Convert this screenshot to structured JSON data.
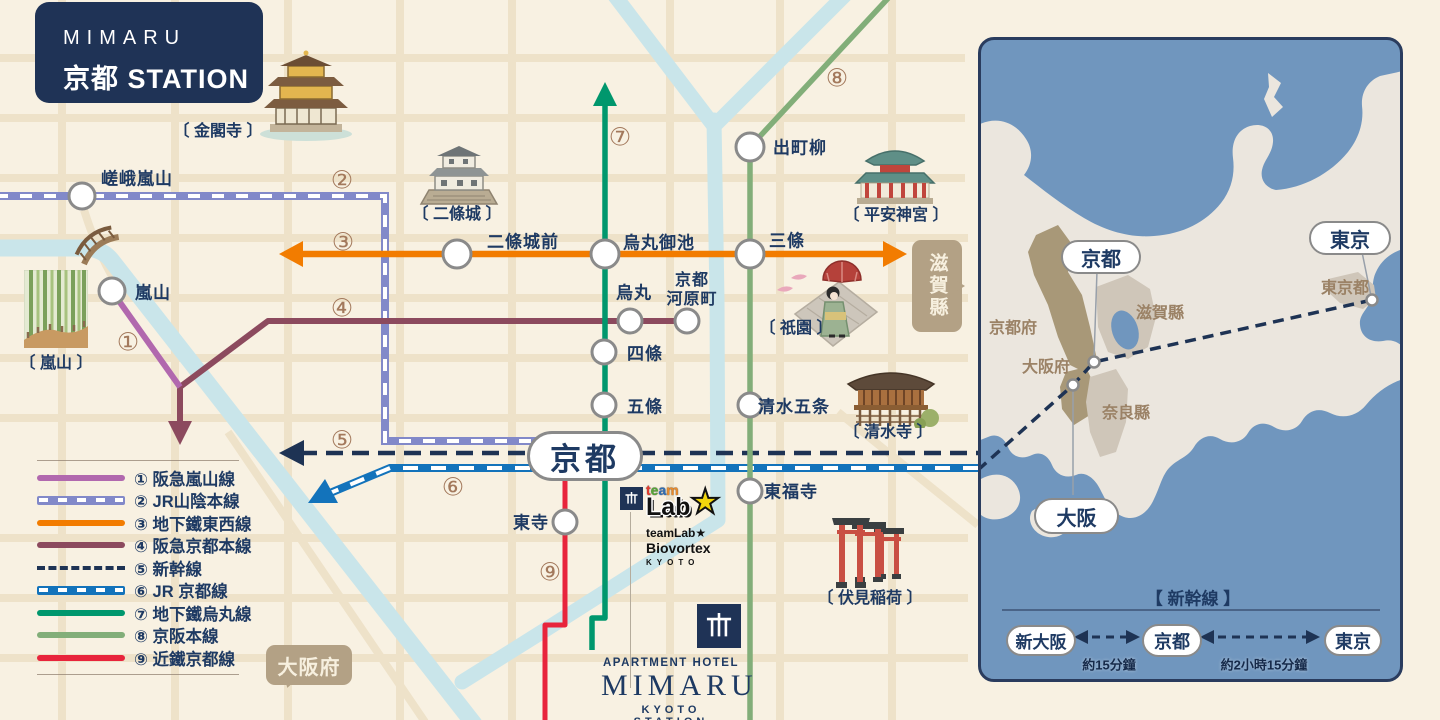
{
  "brand": {
    "line1": "MIMARU",
    "line2": "京都 STATION"
  },
  "lines": [
    {
      "badge": "①",
      "name": "阪急嵐山線",
      "legend_label": "① 阪急嵐山線",
      "color": "#b168ae",
      "style": "solid"
    },
    {
      "badge": "②",
      "name": "JR山陰本線",
      "legend_label": "② JR山陰本線",
      "color": "#8289c9",
      "style": "jr"
    },
    {
      "badge": "③",
      "name": "地下鐵東西線",
      "legend_label": "③ 地下鐵東西線",
      "color": "#f27c00",
      "style": "solid"
    },
    {
      "badge": "④",
      "name": "阪急京都本線",
      "legend_label": "④ 阪急京都本線",
      "color": "#8c4a5e",
      "style": "solid"
    },
    {
      "badge": "⑤",
      "name": "新幹線",
      "legend_label": "⑤ 新幹線",
      "color": "#1e3354",
      "style": "dashed"
    },
    {
      "badge": "⑥",
      "name": "JR京都線",
      "legend_label": "⑥ JR 京都線",
      "color": "#1373bb",
      "style": "jr"
    },
    {
      "badge": "⑦",
      "name": "地下鐵烏丸線",
      "legend_label": "⑦ 地下鐵烏丸線",
      "color": "#00976d",
      "style": "solid"
    },
    {
      "badge": "⑧",
      "name": "京阪本線",
      "legend_label": "⑧ 京阪本線",
      "color": "#82ae79",
      "style": "solid"
    },
    {
      "badge": "⑨",
      "name": "近鐵京都線",
      "legend_label": "⑨ 近鐵京都線",
      "color": "#e8243c",
      "style": "solid"
    }
  ],
  "stations": [
    {
      "name": "嵯峨嵐山"
    },
    {
      "name": "嵐山"
    },
    {
      "name": "二條城前"
    },
    {
      "name": "烏丸御池"
    },
    {
      "name": "三條"
    },
    {
      "name": "出町柳"
    },
    {
      "name": "烏丸"
    },
    {
      "name": "京都河原町",
      "line1": "京都",
      "line2": "河原町"
    },
    {
      "name": "四條"
    },
    {
      "name": "五條"
    },
    {
      "name": "清水五条"
    },
    {
      "name": "東福寺"
    },
    {
      "name": "東寺"
    }
  ],
  "hub": {
    "label": "京都"
  },
  "landmarks": [
    {
      "label": "〔 金閣寺 〕"
    },
    {
      "label": "〔 二條城 〕"
    },
    {
      "label": "〔 平安神宮 〕"
    },
    {
      "label": "〔 嵐山 〕"
    },
    {
      "label": "〔 祇園 〕"
    },
    {
      "label": "〔 清水寺 〕"
    },
    {
      "label": "〔 伏見稲荷 〕"
    }
  ],
  "bubbles": {
    "osaka": "大阪府",
    "shiga": "滋賀縣"
  },
  "teamlab": {
    "letters": [
      {
        "ch": "t",
        "style": "color:#e63b2e"
      },
      {
        "ch": "e",
        "style": "color:#55a735"
      },
      {
        "ch": "a",
        "style": "color:#2f6eb5"
      },
      {
        "ch": "m",
        "style": "color:#e98a2b"
      }
    ],
    "lab": "Lab",
    "star": "★",
    "sub1": "teamLab★",
    "sub2": "Biovortex",
    "sub3": "KYOTO"
  },
  "hotel": {
    "top": "APARTMENT HOTEL",
    "name": "MIMARU",
    "sub": "KYOTO STATION"
  },
  "inset": {
    "regions": [
      {
        "label": "京都府"
      },
      {
        "label": "大阪府"
      },
      {
        "label": "滋賀縣"
      },
      {
        "label": "奈良縣"
      },
      {
        "label": "東京都"
      }
    ],
    "pills": [
      {
        "label": "京都"
      },
      {
        "label": "東京"
      },
      {
        "label": "大阪"
      }
    ],
    "shinkansen": {
      "title": "【 新幹線 】",
      "stops": [
        {
          "label": "新大阪"
        },
        {
          "label": "京都"
        },
        {
          "label": "東京"
        }
      ],
      "durations": [
        {
          "label": "約15分鐘"
        },
        {
          "label": "約2小時15分鐘"
        }
      ]
    }
  },
  "colors": {
    "bg": "#f8f1e2",
    "road": "#ecdfc3",
    "river": "#c9e5ea",
    "sea": "#7096be",
    "land": "#ebe6de",
    "pref_brown": "#a89878",
    "pref_gray": "#cfc6b9",
    "badge": "#a3795c",
    "text_navy": "#1e3a63",
    "bubble": "#b3a185",
    "navy_box": "#1f3356"
  }
}
